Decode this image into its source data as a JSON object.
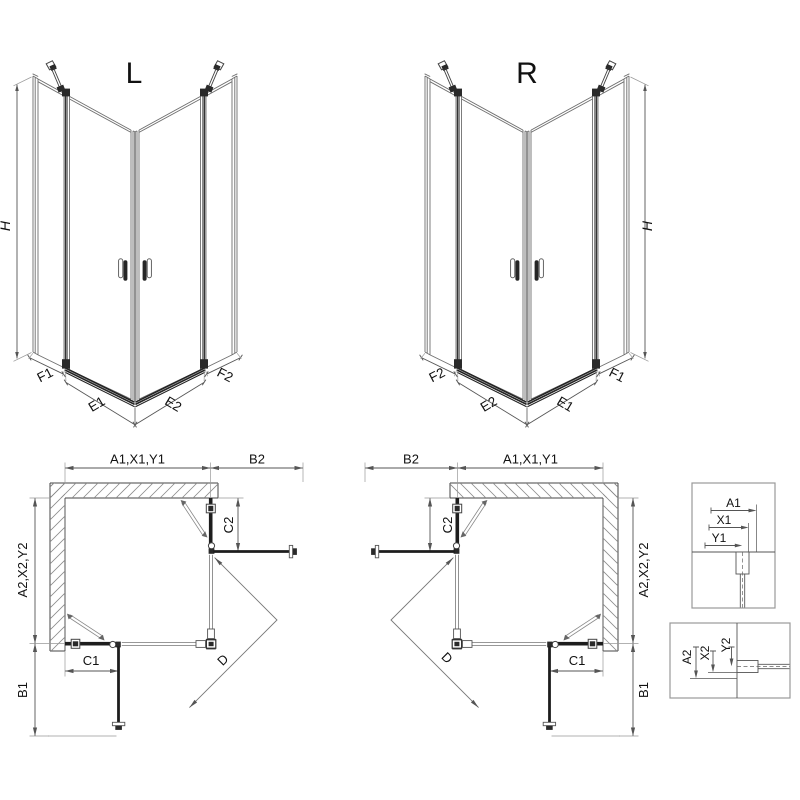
{
  "l_view": {
    "title": "L",
    "height": "H",
    "f1": "F1",
    "e1": "E1",
    "e2": "E2",
    "f2": "F2"
  },
  "r_view": {
    "title": "R",
    "height": "H",
    "f1": "F1",
    "e1": "E1",
    "e2": "E2",
    "f2": "F2"
  },
  "left_plan": {
    "top_width": "A1,X1,Y1",
    "door_ext_top": "B2",
    "fixed_right": "C2",
    "side_depth": "A2,X2,Y2",
    "fixed_bottom": "C1",
    "door_ext_bottom": "B1",
    "entry": "D"
  },
  "right_plan": {
    "top_width": "A1,X1,Y1",
    "door_ext_top": "B2",
    "fixed_right": "C2",
    "side_depth": "A2,X2,Y2",
    "fixed_bottom": "C1",
    "door_ext_bottom": "B1",
    "entry": "D"
  },
  "detail_top": {
    "a1": "A1",
    "x1": "X1",
    "y1": "Y1"
  },
  "detail_bottom": {
    "a2": "A2",
    "x2": "X2",
    "y2": "Y2"
  },
  "colors": {
    "line": "#6e6e6e",
    "strong": "#444444",
    "dark": "#1d1d1d",
    "hatch": "#8a8a8a",
    "dim": "#555555",
    "box_border": "#999999",
    "text": "#111111"
  }
}
